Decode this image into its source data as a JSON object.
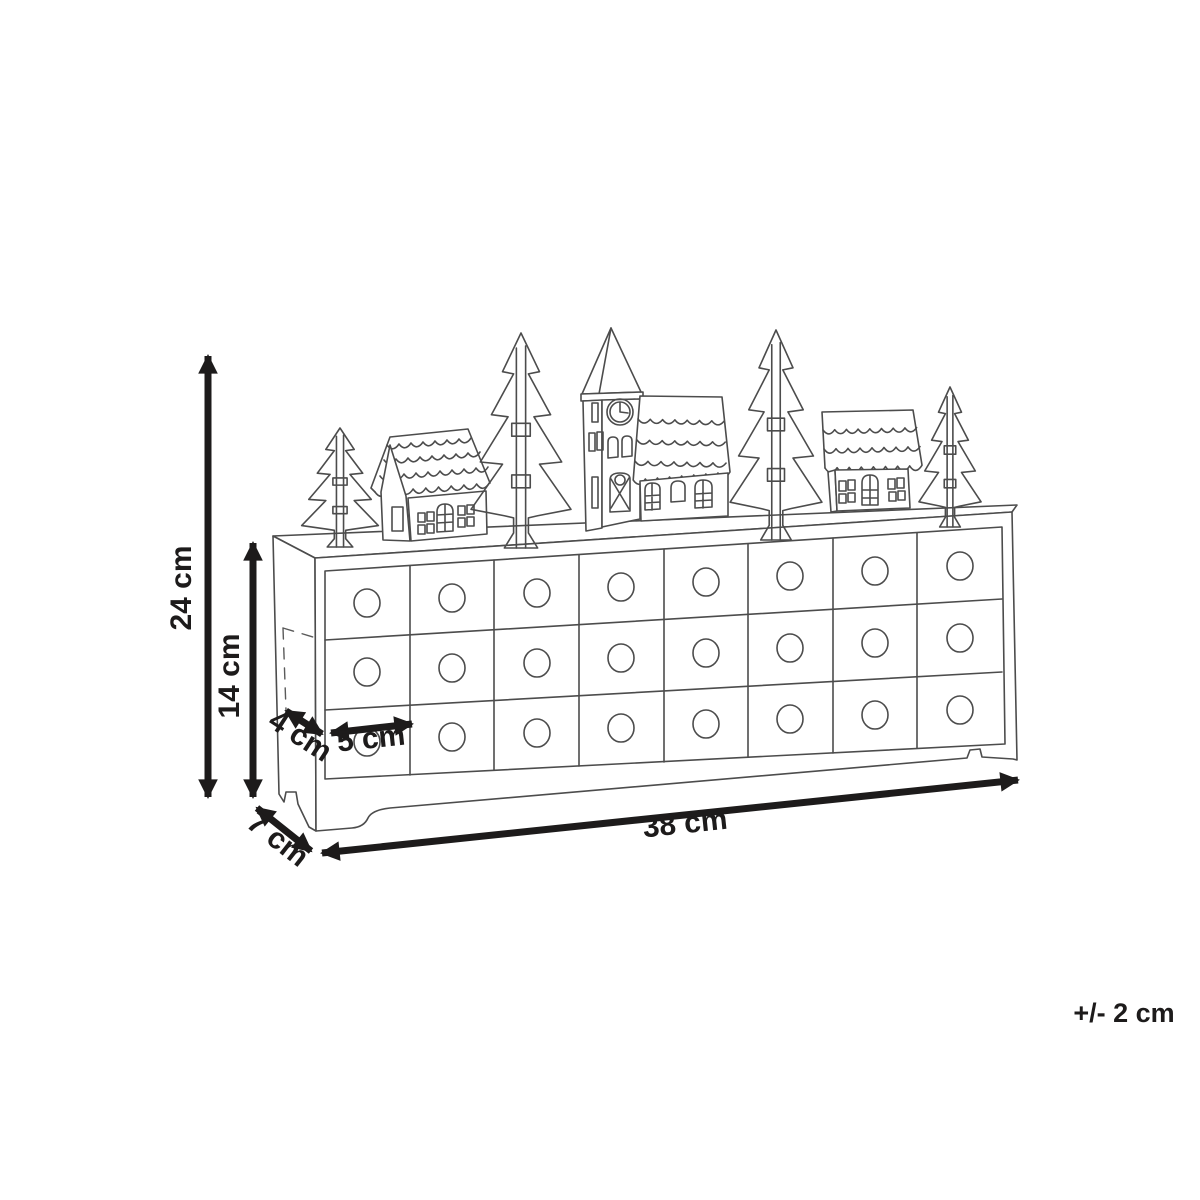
{
  "diagram": {
    "product": "Wooden advent calendar: village scene with fir trees, houses and a clock-tower church standing on a 24-drawer chest",
    "units": "cm",
    "background": "#ffffff",
    "line_color": "#4c4c4c",
    "dimension_color": "#1d1b1b"
  },
  "dimensions": {
    "total_height": "24 cm",
    "body_height": "14 cm",
    "side_depth": "4 cm",
    "drawer_width": "5 cm",
    "total_width": "38 cm",
    "base_depth": "7 cm"
  },
  "tolerance": "+/- 2 cm",
  "drawers": {
    "rows": 3,
    "columns": 8,
    "total": 24
  },
  "village": [
    "fir-tree",
    "house",
    "fir-tree",
    "church-with-clock-tower",
    "fir-tree",
    "house",
    "fir-tree"
  ]
}
